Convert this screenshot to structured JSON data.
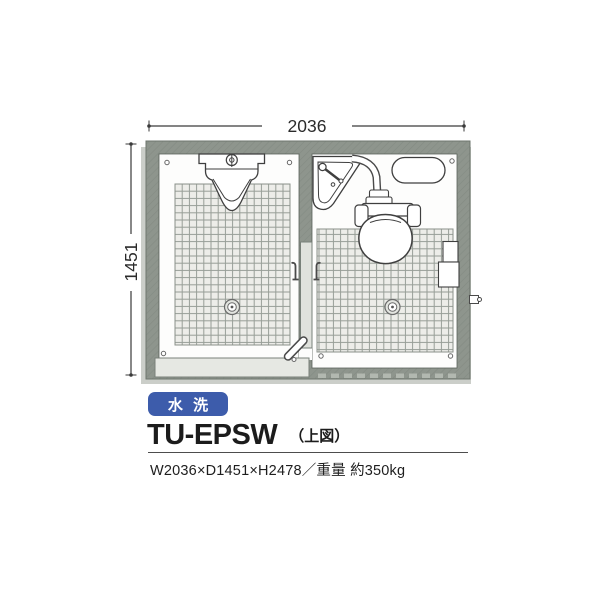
{
  "product": {
    "badge_label": "水 洗",
    "model": "TU-EPSW",
    "view_note": "（上図）",
    "spec_line": "W2036×D1451×H2478／重量 約350kg"
  },
  "diagram": {
    "width_mm": "2036",
    "depth_mm": "1451",
    "left_room_fixtures": [
      "urinal",
      "floor-drain",
      "coat-hook",
      "door-handle",
      "entry-step"
    ],
    "right_room_fixtures": [
      "corner-sink",
      "flush-toilet",
      "water-tank",
      "paper-holder",
      "floor-drain",
      "coat-hook"
    ]
  },
  "colors": {
    "badge_blue": "#3d5cab",
    "wall_gray": "#8e958d",
    "tile_fill": "#edede9",
    "tile_line": "#979e97",
    "floor_white": "#fdfdfc",
    "shadow_gray": "#cbcec9",
    "line_dark": "#3f3f3f"
  }
}
